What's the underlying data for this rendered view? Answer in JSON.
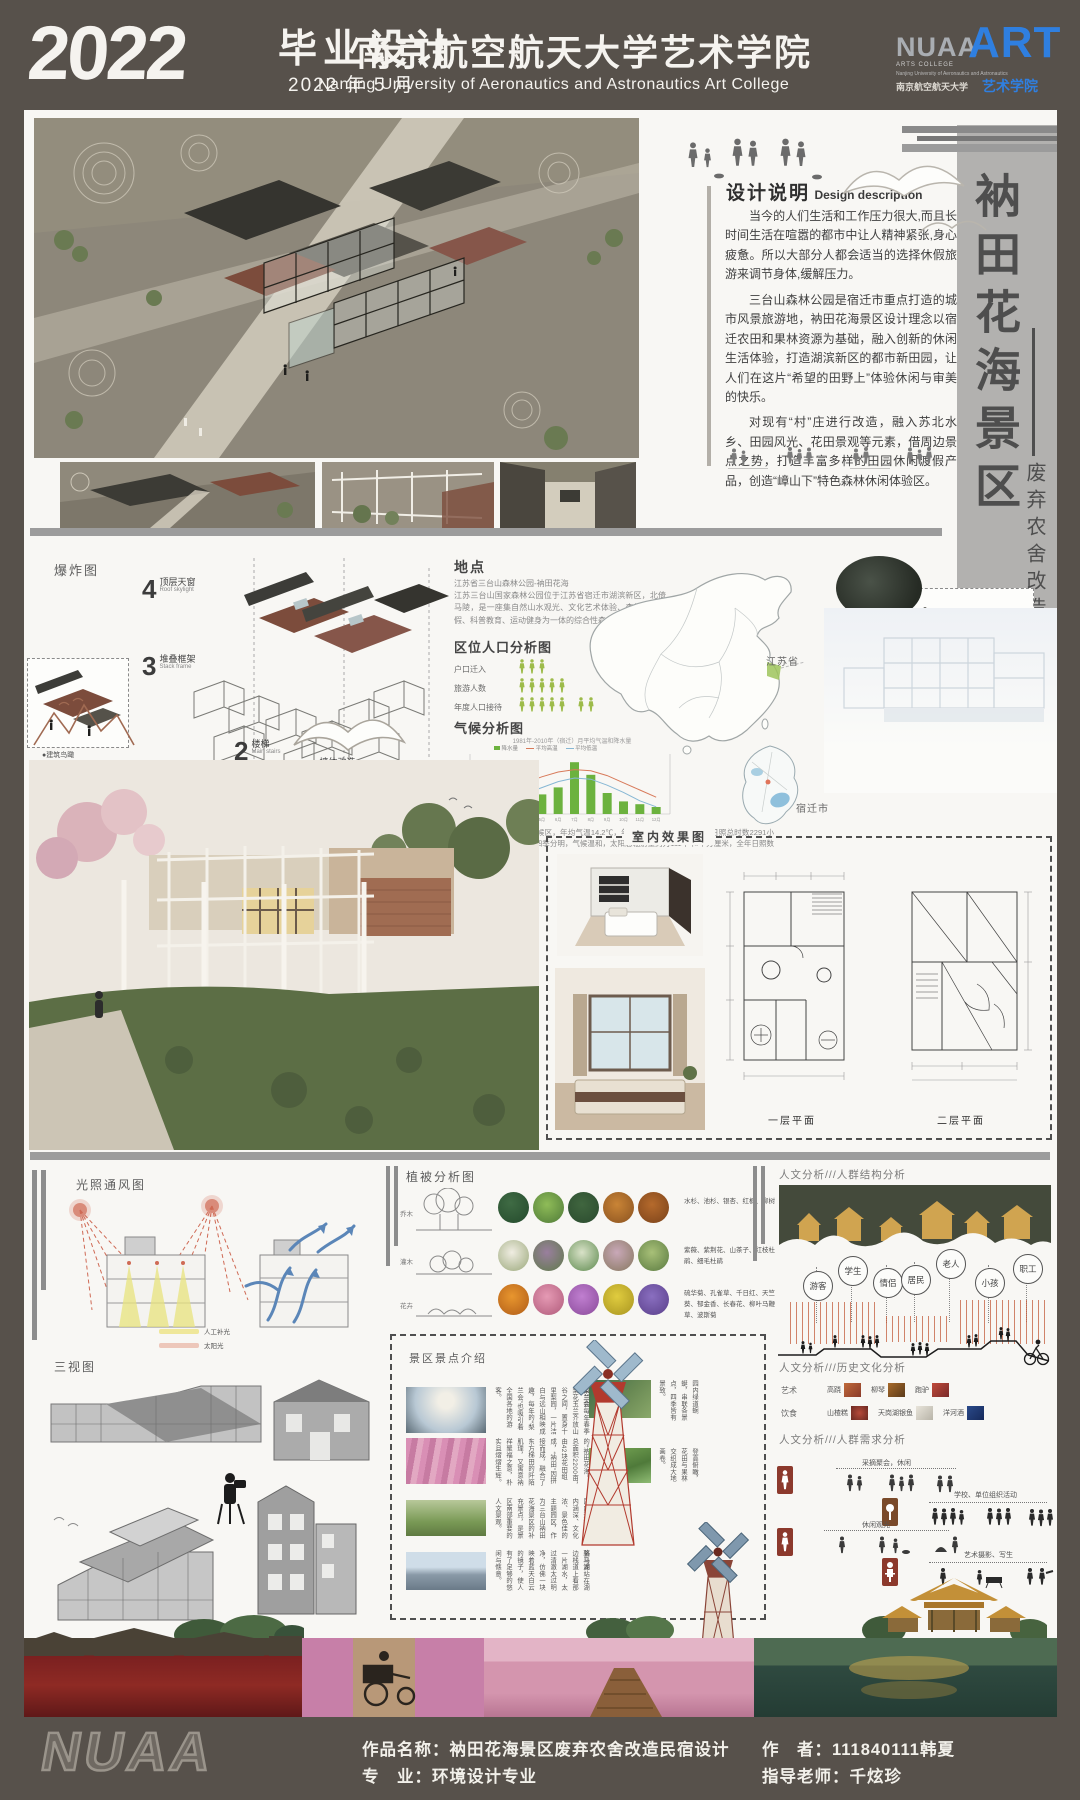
{
  "header": {
    "year": "2022",
    "title": "毕业设计",
    "date": "2022 年 5 月",
    "school_cn": "南京航空航天大学艺术学院",
    "school_en": "Nanjing University of Aeronautics and Astronautics Art College",
    "logo": {
      "nuaa": "NUAA",
      "art": "ART",
      "line1": "ARTS COLLEGE",
      "line2": "Nanjing University of Aeronautics and Astronautics",
      "cn": "南京航空航天大学",
      "cn2": "艺术学院"
    }
  },
  "side_title": {
    "main": "衲田花海景区",
    "sub": "废弃农舍改造民宿设计"
  },
  "design_desc": {
    "title_cn": "设计说明",
    "title_en": "Design description",
    "p1": "当今的人们生活和工作压力很大,而且长时间生活在喧嚣的都市中让人精神紧张,身心疲惫。所以大部分人都会适当的选择休假旅游来调节身体,缓解压力。",
    "p2": "三台山森林公园是宿迁市重点打造的城市风景旅游地，衲田花海景区设计理念以宿迁农田和果林资源为基础，融入创新的休闲生活体验，打造湖滨新区的都市新田园，让人们在这片“希望的田野上”体验休闲与审美的快乐。",
    "p3": "对现有“村”庄进行改造，融入苏北水乡、田园风光、花田景观等元素，借周边景点之势，打造丰富多样的田园休闲渡假产品，创造“嶂山下”特色森林休闲体验区。"
  },
  "exploded": {
    "title": "爆炸图",
    "steps": [
      {
        "num": "4",
        "cn": "顶层天窗",
        "en": "Roof skylight"
      },
      {
        "num": "3",
        "cn": "堆叠框架",
        "en": "Stack frame"
      },
      {
        "num": "2",
        "cn": "楼梯",
        "en": "Main stairs"
      },
      {
        "num": "1",
        "cn": "墙体改造",
        "en": "Wall"
      }
    ],
    "thumb_left": "●建筑鸟瞰",
    "thumb_right": "●墙体侧面 Side of wall"
  },
  "location": {
    "title": "地点",
    "line1": "江苏省三台山森林公园-衲田花海",
    "body": "江苏三台山国家森林公园位于江苏省宿迁市湖滨新区，北倚马陵，是一座集自然山水观光、文化艺术体验、森林休闲度假、科普教育、运动健身为一体的综合性森林公园。"
  },
  "population": {
    "title": "区位人口分析图",
    "rows": [
      {
        "label": "户口迁入",
        "count": 3
      },
      {
        "label": "旅游人数",
        "count": 5
      },
      {
        "label": "年度人口接待",
        "count": 7
      }
    ]
  },
  "climate": {
    "title": "气候分析图",
    "caption": "1981年-2010年（宿迁）月平均气温和降水量",
    "legend": [
      "降水量",
      "平均高温",
      "平均低温"
    ],
    "note": "宿迁市属于暖温带季风气候区，年均气温14.2℃，年均降水量910毫米，年均日照总时数2291小时，光热资源比较优越，四季分明，气候温和，太阳总辐射量约为111千卡/平方厘米，全年日照数2271小时。"
  },
  "chart_data": {
    "type": "bar+line",
    "title": "1981年-2010年（宿迁）月平均气温和降水量",
    "categories": [
      "1月",
      "2月",
      "3月",
      "4月",
      "5月",
      "6月",
      "7月",
      "8月",
      "9月",
      "10月",
      "11月",
      "12月"
    ],
    "series": [
      {
        "name": "降水量(mm)",
        "type": "bar",
        "values": [
          25,
          20,
          45,
          55,
          70,
          95,
          185,
          140,
          75,
          45,
          35,
          25
        ]
      },
      {
        "name": "平均高温(℃)",
        "type": "line",
        "values": [
          7,
          9,
          14,
          21,
          26,
          30,
          32,
          31,
          27,
          21,
          15,
          9
        ]
      },
      {
        "name": "平均低温(℃)",
        "type": "line",
        "values": [
          -1,
          1,
          6,
          12,
          17,
          22,
          25,
          24,
          19,
          13,
          6,
          1
        ]
      }
    ],
    "ylabel": "降水量",
    "grid": false,
    "legend_position": "top"
  },
  "maps": {
    "province": "江苏省",
    "city": "宿迁市"
  },
  "interior": {
    "box_title": "室内效果图",
    "plan1": "一层平面",
    "plan2": "二层平面"
  },
  "sunvent": {
    "title": "光照通风图",
    "legend": [
      {
        "label": "人工补光",
        "color": "#efe79a"
      },
      {
        "label": "太阳光",
        "color": "#edc7ba"
      }
    ]
  },
  "threeview": {
    "title": "三视图"
  },
  "vegetation": {
    "title": "植被分析图",
    "rows": [
      {
        "cat": "乔木",
        "desc": "水杉、池杉、银杏、红枫、柳树"
      },
      {
        "cat": "灌木",
        "desc": "紫薇、紫荆花、山茶子、红枝杜鹃、细毛杜鹃"
      },
      {
        "cat": "花卉",
        "desc": "硫华菊、孔雀草、千日红、天竺葵、郁金香、长春花、柳叶马鞭草、波斯菊"
      }
    ]
  },
  "scenic": {
    "title": "景区景点介绍",
    "spots": [
      {
        "name": "梨兰会",
        "desc": "每年春季梨花玉兰齐放山谷之间，置身十里梨园，一片洁白与远山相映成趣，每年的“梨兰会”也吸引着全国各地的游客。"
      },
      {
        "name": "衲田花海",
        "desc": "公园内的“衲田花海”，总面积2200亩，由42块花田组成，“衲田”因拼接而成，融合了东方梯田的阡陌肌理，又寓意衲祥聚福之意，朴实且熠熠生辉。"
      },
      {
        "name": "中华孝道景观文化园",
        "desc": "定位为国内规模大、内涵深、文化浓、景色佳的主题园区，作为三台山衲田花海景区的补充景点，是景区南部重要的人文景观。"
      },
      {
        "name": "骆马湖",
        "desc": "站在湖边栈道上看那一片湖水，太过清澈太过明净，仿佛一块映着蓝天白云的镜子，使人有了足够的悠闲与惬意。"
      }
    ],
    "side_spots": [
      {
        "desc": "园内绿道蜿蜒，串联各景点，四季皆有景致。"
      },
      {
        "desc": "登高俯瞰，花田与果林交织成大地画卷。"
      }
    ]
  },
  "humanities": {
    "h1": "人文分析///人群结构分析",
    "groups": [
      "游客",
      "学生",
      "情侣",
      "居民",
      "老人",
      "小孩",
      "职工"
    ],
    "h2": "人文分析///历史文化分析",
    "culture": [
      {
        "cat": "艺术",
        "items": [
          "高跷",
          "柳琴",
          "跑驴"
        ]
      },
      {
        "cat": "饮食",
        "items": [
          "山楂糕",
          "天岗湖银鱼",
          "洋河酒"
        ]
      }
    ],
    "h3": "人文分析///人群需求分析",
    "needs": [
      "采摘聚会，休闲",
      "学校、单位组织活动",
      "休闲观光",
      "艺术摄影、写生"
    ]
  },
  "footer": {
    "nuaa": "NUAA",
    "work_label": "作品名称：",
    "work": "衲田花海景区废弃农舍改造民宿设计",
    "major_label": "专　业：",
    "major": "环境设计专业",
    "author_label": "作　者：",
    "author": "111840111韩夏",
    "advisor_label": "指导老师：",
    "advisor": "千炫珍"
  }
}
